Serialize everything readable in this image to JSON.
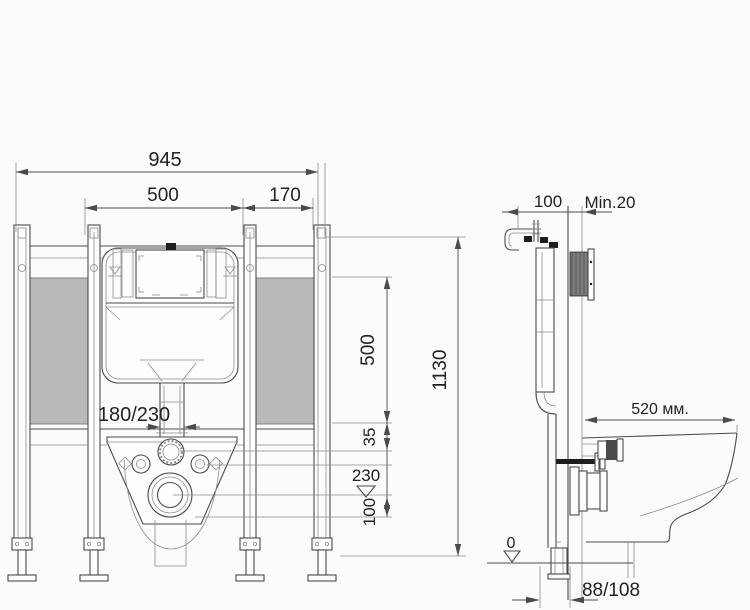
{
  "front_view": {
    "width_total": "945",
    "width_frame": "500",
    "width_side": "170",
    "inlet_offset": "180/230",
    "height_total": "1130",
    "height_water_level": "500",
    "gap_top": "35",
    "level_drain": "230",
    "height_outlet": "100"
  },
  "side_view": {
    "depth_frame": "100",
    "wall_min_gap": "Min.20",
    "bowl_length": "520 мм.",
    "floor_level": "0",
    "outlet_distance": "88/108"
  },
  "colors": {
    "bg": "#fbfbfb",
    "line": "#4b4b4b",
    "line-light": "#8c8c8c",
    "panel": "#b9b9b9",
    "ink": "#222222",
    "dark": "#1e1e1e"
  }
}
